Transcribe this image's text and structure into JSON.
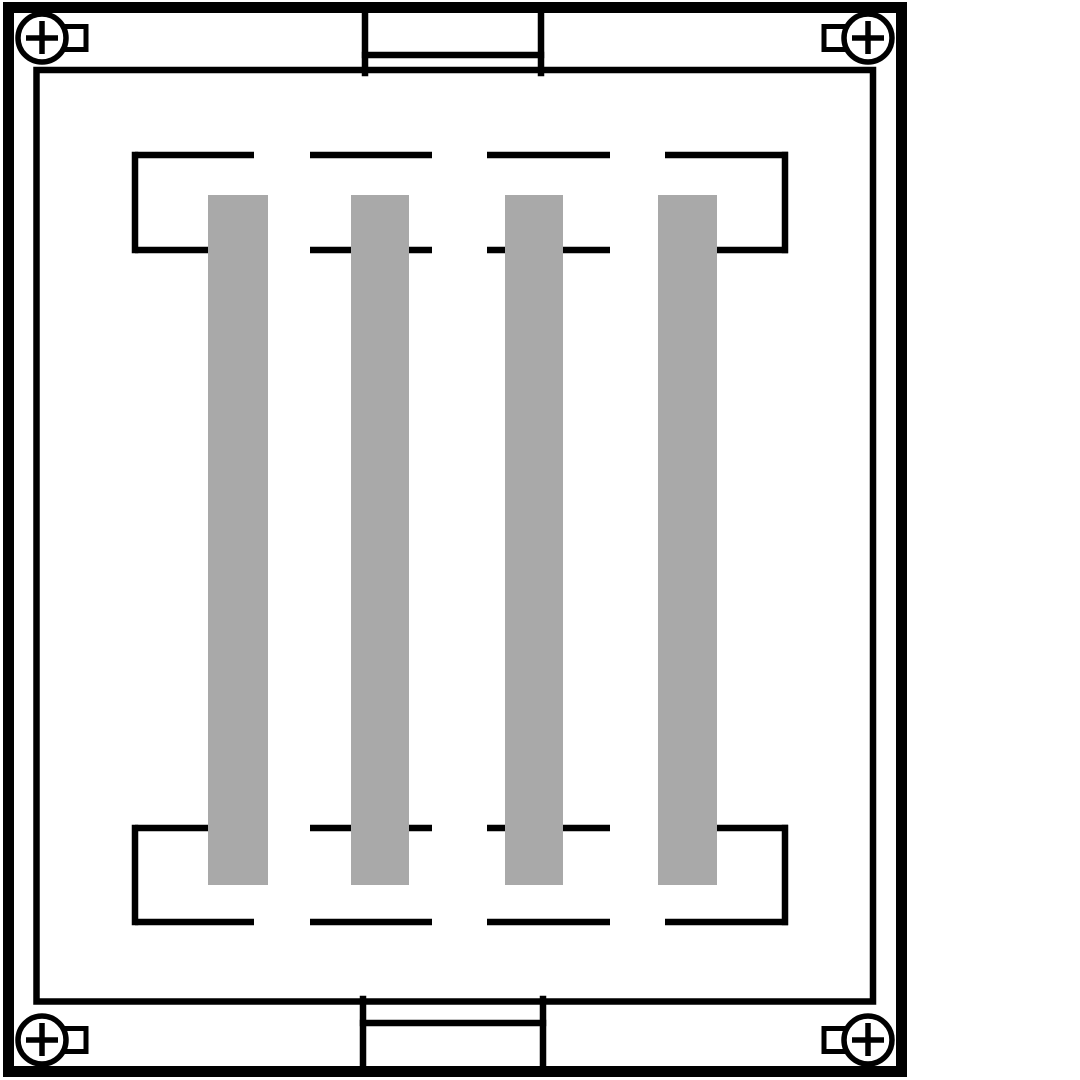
{
  "diagram": {
    "canvas": {
      "width": 1080,
      "height": 1080
    },
    "colors": {
      "background": "#ffffff",
      "line": "#000000",
      "bar_fill": "#a9a9a9",
      "screw_fill": "#ffffff"
    },
    "strokes": {
      "outer_frame": 11,
      "inner_frame": 6.5,
      "tab": 6.5,
      "bracket": 6.5,
      "screw": 5.5,
      "square_lug": 5
    },
    "outer_frame": {
      "x": 8.5,
      "y": 7.5,
      "width": 893,
      "height": 1064
    },
    "inner_frame": {
      "x": 36.5,
      "y": 70,
      "width": 836.5,
      "height": 931.5
    },
    "top_tab": {
      "x_left": 365,
      "x_right": 541,
      "y_start": 8,
      "y_shelf": 55,
      "y_end": 73
    },
    "bottom_tab": {
      "x_left": 363,
      "x_right": 543,
      "y_start": 999,
      "y_shelf": 1023,
      "y_end": 1070
    },
    "brackets": [
      {
        "name": "top-element-bracket",
        "x_left": 135,
        "x_right": 785,
        "y_top": 155,
        "y_bottom": 250,
        "dash_segments": [
          [
            135,
            254
          ],
          [
            310,
            432
          ],
          [
            487,
            610
          ],
          [
            665,
            788
          ]
        ]
      },
      {
        "name": "bottom-element-bracket",
        "x_left": 135,
        "x_right": 785,
        "y_top": 828,
        "y_bottom": 922,
        "dash_segments": [
          [
            135,
            254
          ],
          [
            310,
            432
          ],
          [
            487,
            610
          ],
          [
            665,
            788
          ]
        ]
      }
    ],
    "bars": [
      {
        "name": "element-bar-1",
        "x": 208,
        "y": 195,
        "width": 60,
        "height": 690
      },
      {
        "name": "element-bar-2",
        "x": 351,
        "y": 195,
        "width": 58,
        "height": 690
      },
      {
        "name": "element-bar-3",
        "x": 505,
        "y": 195,
        "width": 58,
        "height": 690
      },
      {
        "name": "element-bar-4",
        "x": 658,
        "y": 195,
        "width": 59,
        "height": 690
      }
    ],
    "screws": [
      {
        "name": "screw-top-left",
        "cx": 42,
        "cy": 38,
        "r": 24,
        "cross_arm": 16,
        "square": {
          "x": 64,
          "y": 26.5,
          "width": 22,
          "height": 23
        }
      },
      {
        "name": "screw-top-right",
        "cx": 868,
        "cy": 38,
        "r": 24,
        "cross_arm": 16,
        "square": {
          "x": 824,
          "y": 26.5,
          "width": 22,
          "height": 23
        }
      },
      {
        "name": "screw-bottom-left",
        "cx": 42,
        "cy": 1040,
        "r": 24,
        "cross_arm": 16,
        "square": {
          "x": 64,
          "y": 1028.5,
          "width": 22,
          "height": 23
        }
      },
      {
        "name": "screw-bottom-right",
        "cx": 868,
        "cy": 1040,
        "r": 24,
        "cross_arm": 16,
        "square": {
          "x": 824,
          "y": 1028.5,
          "width": 22,
          "height": 23
        }
      }
    ]
  }
}
